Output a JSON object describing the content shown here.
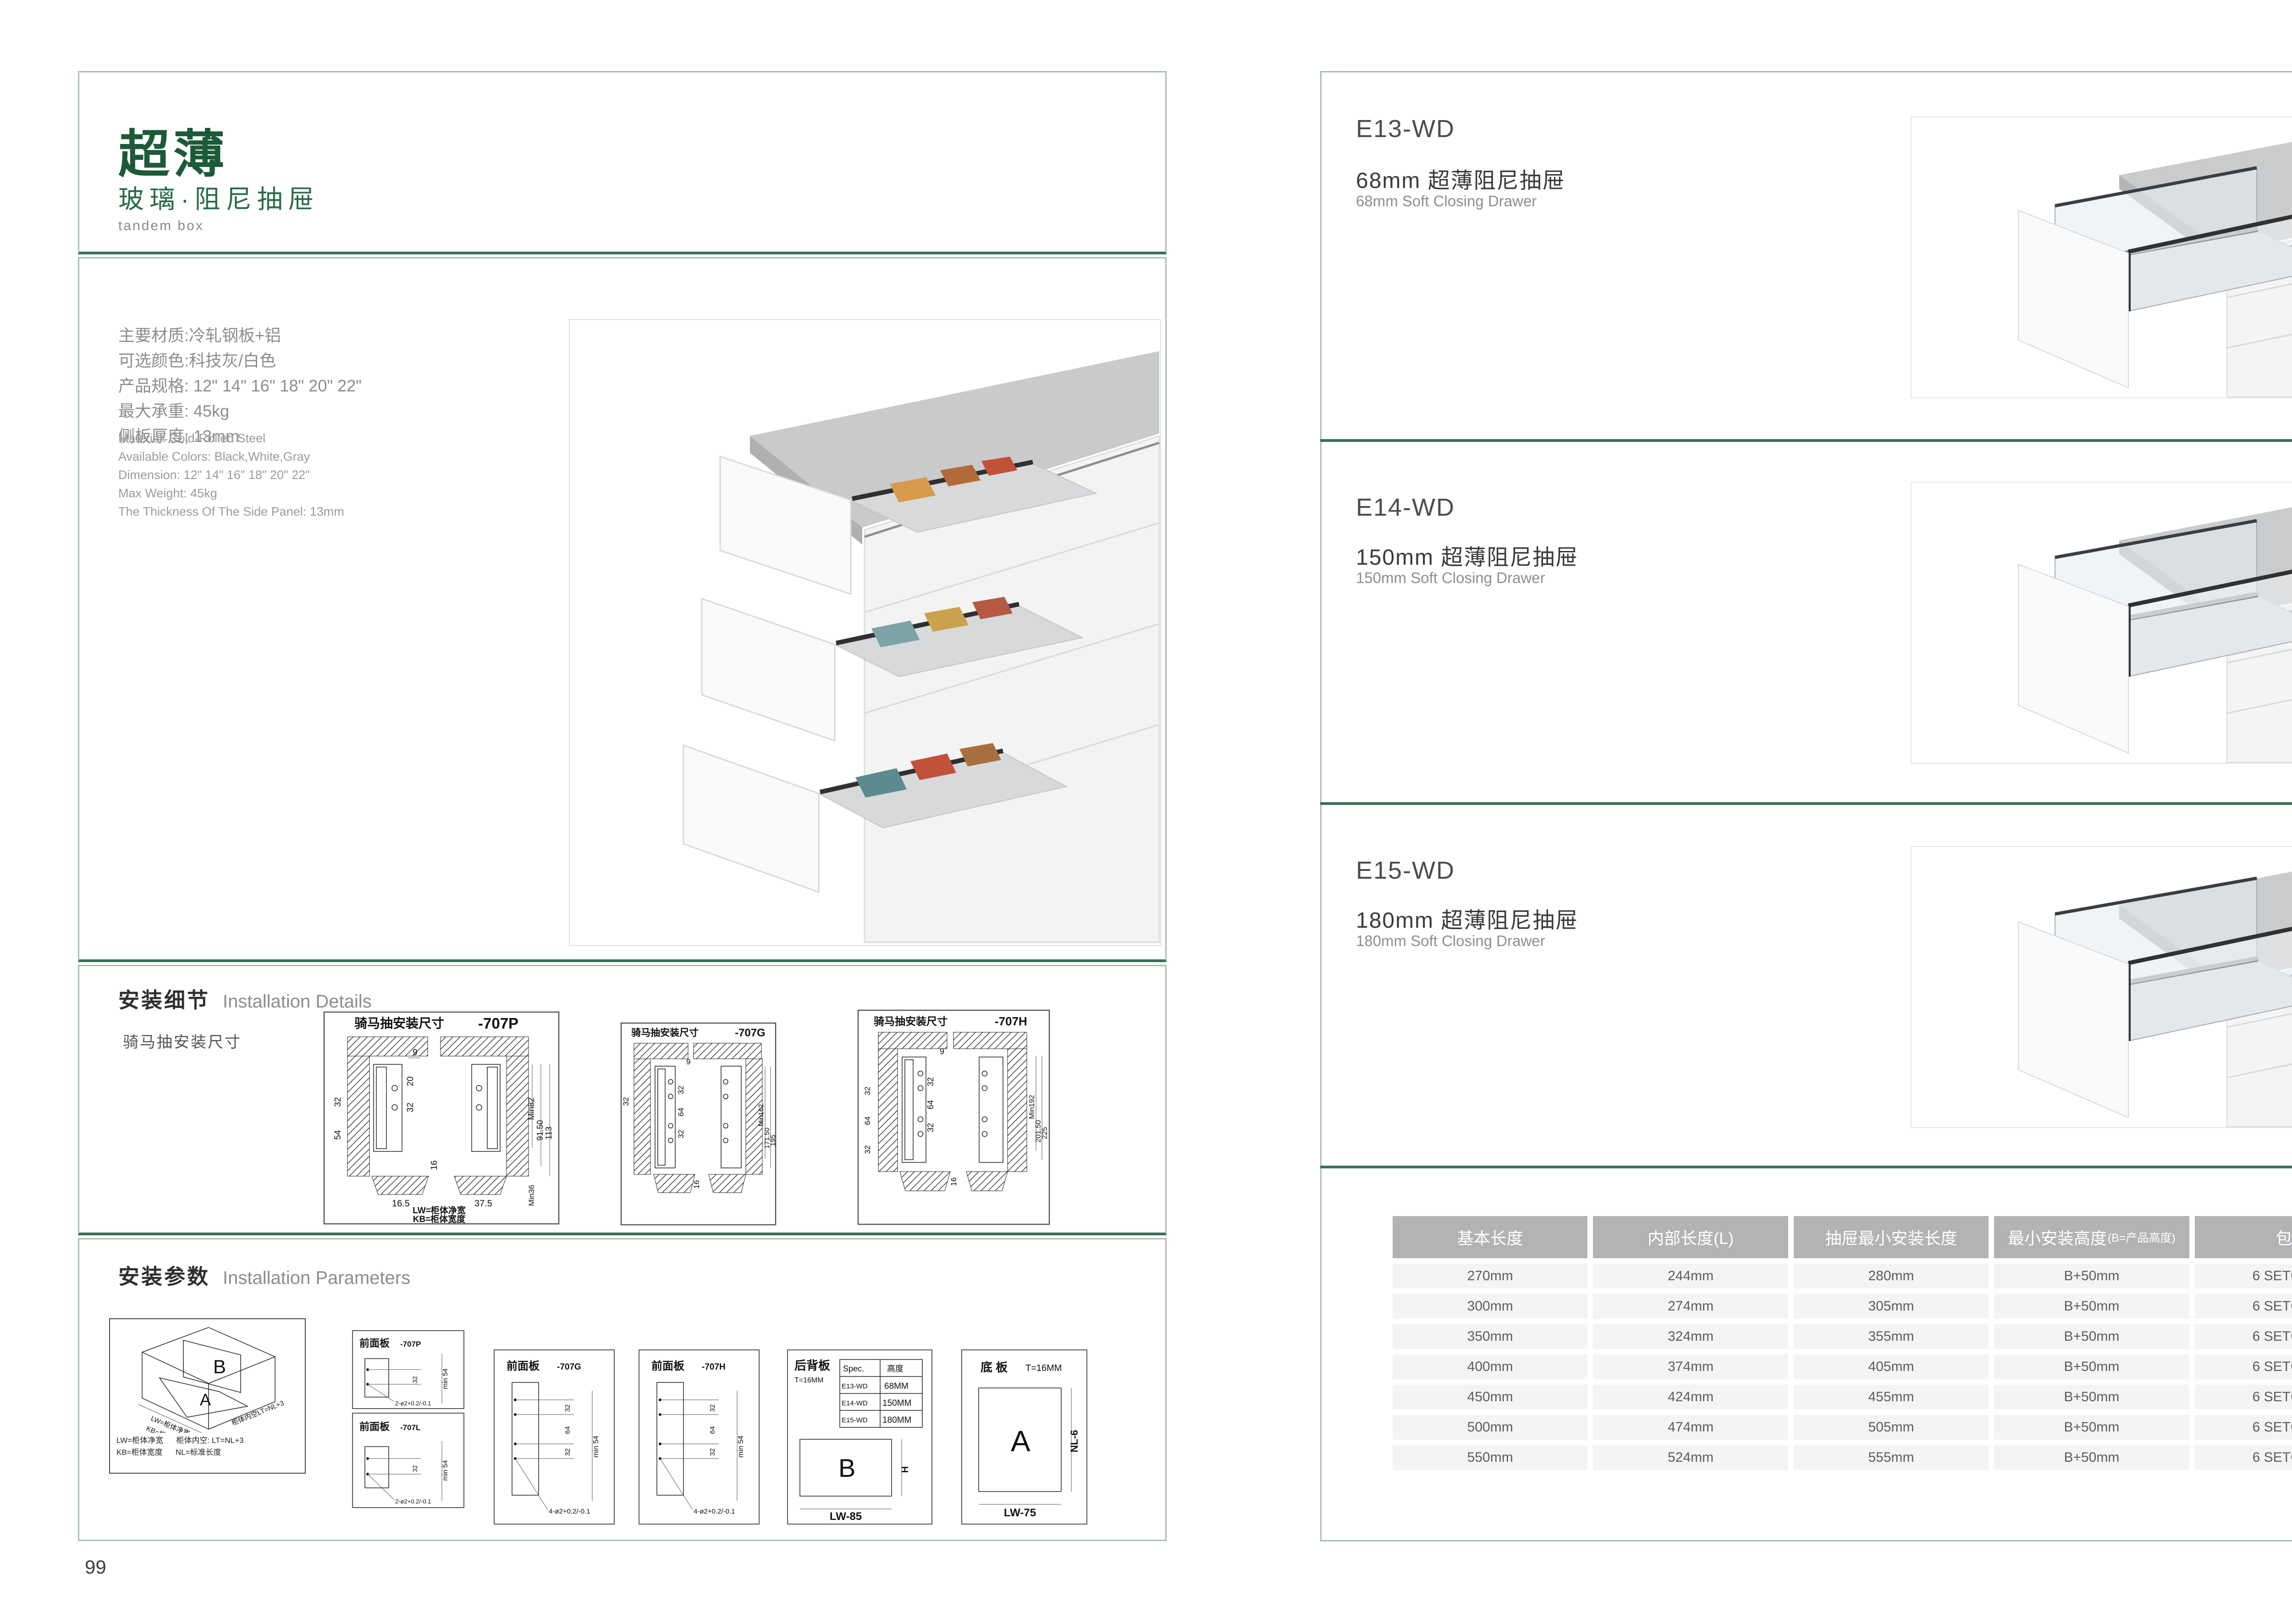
{
  "left": {
    "title": "超薄",
    "subtitle": "玻璃·阻尼抽屉",
    "tagline": "tandem box",
    "specs_zh": [
      "主要材质:冷轧钢板+铝",
      "可选颜色:科技灰/白色",
      "产品规格: 12\" 14\" 16\" 18\" 20\" 22\"",
      "最大承重: 45kg",
      "侧板厚度; 13mm"
    ],
    "specs_en": [
      "Material: Cold-Rolled Steel",
      "Available Colors: Black,White,Gray",
      "Dimension: 12\" 14\" 16\" 18\" 20\" 22\"",
      "Max Weight: 45kg",
      "The Thickness Of The Side Panel: 13mm"
    ],
    "details": {
      "heading_zh": "安装细节",
      "heading_en": "Installation Details",
      "subheading": "骑马抽安装尺寸",
      "d707p": {
        "title": "骑马抽安装尺寸",
        "code": "-707P",
        "t9": "9",
        "t20": "20",
        "t32": "32",
        "l32": "32",
        "l54": "54",
        "t16": "16",
        "min": "Min82",
        "h1": "91.50",
        "h2": "113",
        "min36": "Min36",
        "b1": "16.5",
        "b2": "37.5",
        "lw": "LW=柜体净宽",
        "kb": "KB=柜体宽度"
      },
      "d707g": {
        "title": "骑马抽安装尺寸",
        "code": "-707G",
        "t9": "9",
        "s1": "32",
        "s2": "64",
        "s3": "32",
        "l32": "32",
        "t16": "16",
        "min": "Min162",
        "h1": "171.50",
        "h2": "195"
      },
      "d707h": {
        "title": "骑马抽安装尺寸",
        "code": "-707H",
        "t9": "9",
        "s1": "32",
        "s2": "64",
        "s3": "32",
        "la": "32",
        "lb": "64",
        "lc": "32",
        "t16": "16",
        "min": "Min192",
        "h1": "201.50",
        "h2": "225"
      }
    },
    "params": {
      "heading_zh": "安装参数",
      "heading_en": "Installation Parameters",
      "box3d": {
        "b": "B",
        "a": "A",
        "lw": "LW=柜体净宽",
        "kb": "KB=柜体宽度",
        "lt": "柜体内空LT=NL+3",
        "cap1": "LW=柜体净宽",
        "cap2": "柜体内空: LT=NL+3",
        "cap3": "KB=柜体宽度",
        "cap4": "NL=标准长度"
      },
      "front_p": {
        "title": "前面板",
        "code": "-707P",
        "d32": "32",
        "dmin": "min 54",
        "holes": "2-ø2+0.2/-0.1"
      },
      "front_l": {
        "title": "前面板",
        "code": "-707L",
        "d32": "32",
        "dmin": "min 54",
        "holes": "2-ø2+0.2/-0.1"
      },
      "front_g": {
        "title": "前面板",
        "code": "-707G",
        "s1": "32",
        "s2": "64",
        "s3": "32",
        "dmin": "min 54",
        "holes": "4-ø2+0.2/-0.1"
      },
      "front_h": {
        "title": "前面板",
        "code": "-707H",
        "s1": "32",
        "s2": "64",
        "s3": "32",
        "dmin": "min 54",
        "holes": "4-ø2+0.2/-0.1"
      },
      "back_panel": {
        "title": "后背板",
        "thickness": "T=16MM",
        "spec_col1": "Spec.",
        "spec_col2": "高度",
        "rows": [
          [
            "E13-WD",
            "68MM"
          ],
          [
            "E14-WD",
            "150MM"
          ],
          [
            "E15-WD",
            "180MM"
          ]
        ],
        "label": "B",
        "dim_h": "H",
        "dim_w": "LW-85"
      },
      "bottom_panel": {
        "title": "底 板",
        "thickness": "T=16MM",
        "label": "A",
        "dim_h": "NL-6",
        "dim_w": "LW-75"
      }
    },
    "page_number": "99"
  },
  "right": {
    "sections": [
      {
        "code": "E13-WD",
        "title_zh": "68mm 超薄阻尼抽屉",
        "title_en": "68mm Soft Closing Drawer"
      },
      {
        "code": "E14-WD",
        "title_zh": "150mm 超薄阻尼抽屉",
        "title_en": "150mm Soft Closing Drawer"
      },
      {
        "code": "E15-WD",
        "title_zh": "180mm 超薄阻尼抽屉",
        "title_en": "180mm Soft Closing Drawer"
      }
    ],
    "table": {
      "headers": [
        "基本长度",
        "内部长度(L)",
        "抽屉最小安装长度",
        "最小安装高度",
        "包装"
      ],
      "header4_note": "(B=产品高度)",
      "rows": [
        [
          "270mm",
          "244mm",
          "280mm",
          "B+50mm",
          "6 SETC/TNB"
        ],
        [
          "300mm",
          "274mm",
          "305mm",
          "B+50mm",
          "6 SETC/TNB"
        ],
        [
          "350mm",
          "324mm",
          "355mm",
          "B+50mm",
          "6 SETC/TNB"
        ],
        [
          "400mm",
          "374mm",
          "405mm",
          "B+50mm",
          "6 SETC/TNB"
        ],
        [
          "450mm",
          "424mm",
          "455mm",
          "B+50mm",
          "6 SETC/TNB"
        ],
        [
          "500mm",
          "474mm",
          "505mm",
          "B+50mm",
          "6 SETC/TNB"
        ],
        [
          "550mm",
          "524mm",
          "555mm",
          "B+50mm",
          "6 SETC/TNB"
        ]
      ]
    },
    "page_number": "100"
  }
}
